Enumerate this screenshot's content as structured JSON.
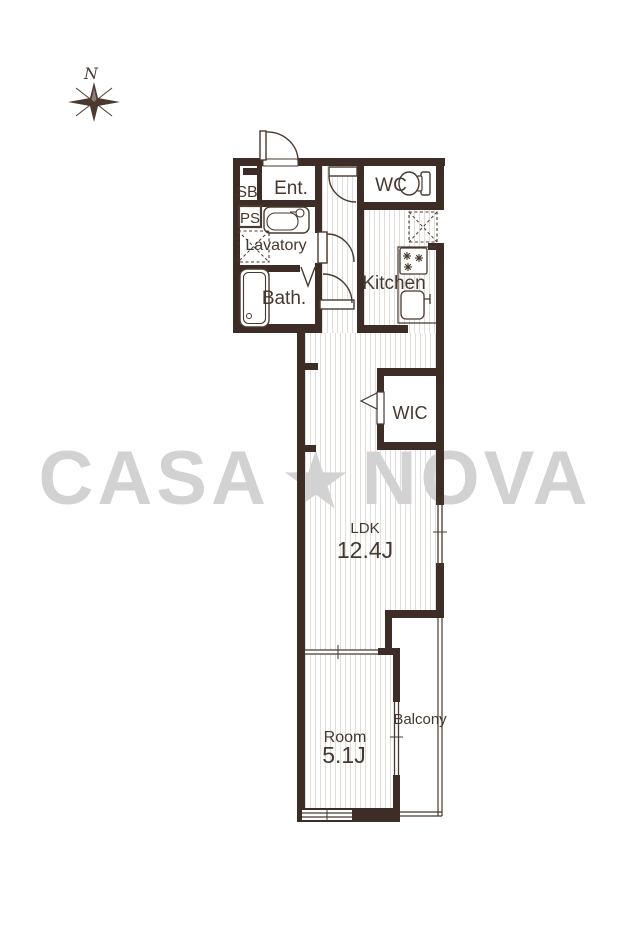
{
  "compass": {
    "north_label": "N"
  },
  "watermark": {
    "left": "CASA",
    "star": "★",
    "right": "NOVA",
    "color": "#d2d2d2"
  },
  "rooms": {
    "sb": "SB",
    "ps": "PS",
    "entrance": "Ent.",
    "wc": "WC",
    "lavatory": "Lavatory",
    "bath": "Bath.",
    "kitchen": "Kitchen",
    "wic": "WIC",
    "ldk_name": "LDK",
    "ldk_size": "12.4J",
    "room_name": "Room",
    "room_size": "5.1J",
    "balcony": "Balcony"
  },
  "colors": {
    "wall": "#3e2d26",
    "line": "#4a392f",
    "label": "#46382e",
    "watermark": "#d2d2d2",
    "floor_hatch": "#e2ddd9"
  }
}
